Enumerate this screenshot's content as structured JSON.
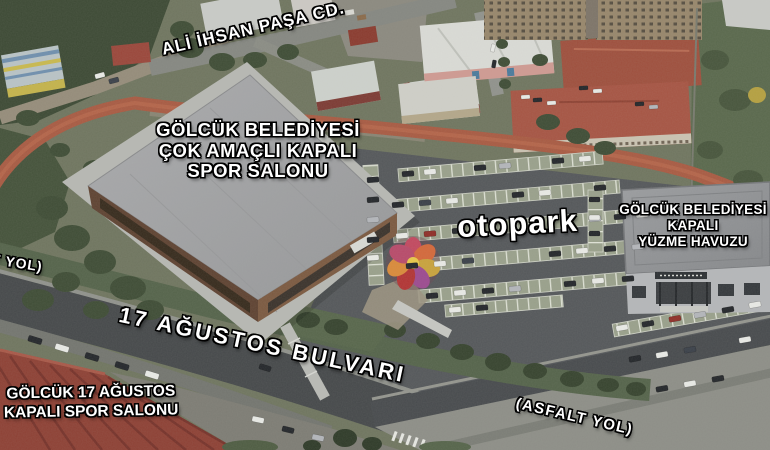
{
  "labels": {
    "street_top": {
      "text": "ALİ İHSAN PAŞA CD."
    },
    "main_hall": {
      "lines": [
        "GÖLCÜK BELEDİYESİ",
        "ÇOK AMAÇLI KAPALI",
        "SPOR SALONU"
      ]
    },
    "parking_lot": {
      "text": "otopark"
    },
    "swimming_pool": {
      "lines": [
        "GÖLCÜK BELEDİYESİ",
        "KAPALI",
        "YÜZME HAVUZU"
      ]
    },
    "boulevard": {
      "text": "17 AĞUSTOS BULVARI"
    },
    "old_sports_hall": {
      "lines": [
        "GÖLCÜK 17 AĞUSTOS",
        "KAPALI SPOR SALONU"
      ]
    },
    "asphalt_road_right": {
      "text": "(ASFALT YOL)"
    },
    "asphalt_road_left": {
      "text": "(ASFALT YOL)"
    }
  },
  "colors": {
    "label_text": "#ffffff",
    "label_outline": "#000000",
    "running_track": "#a85a42",
    "parking_asphalt": "#54575a",
    "main_hall_roof": "#a3a4a6",
    "red_roof": "#8d4034",
    "grass": "#5c6b4c"
  }
}
